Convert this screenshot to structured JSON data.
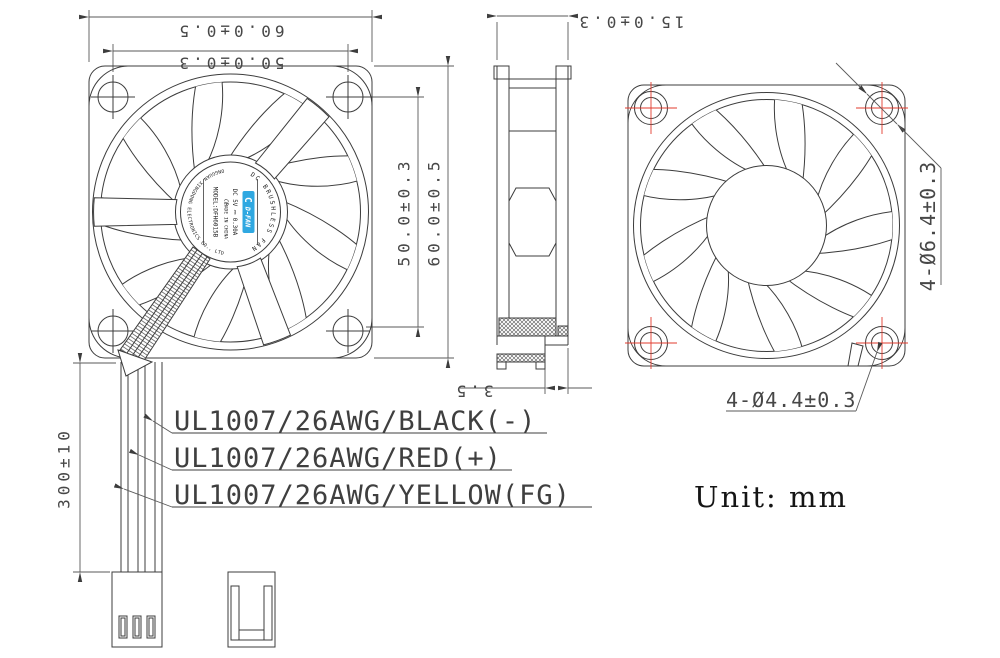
{
  "unit_note": "Unit: mm",
  "front_view": {
    "dim_top_outer": "60.0±0.5",
    "dim_top_inner": "50.0±0.3",
    "dim_right_inner": "50.0±0.3",
    "dim_right_outer": "60.0±0.5",
    "hub_label": {
      "arc_top": "DC BRUSHLESS FAN",
      "arc_bottom": "DONGGUAN XINGDONG ELECTRONICS CO., LTD.",
      "brand": "D-FAN",
      "brand_mark": "C",
      "model": "MODEL:DFH6015B",
      "rating": "DC 5V ⎓ 0.30A",
      "ce_mark": "CE",
      "origin": "MADE IN CHINA"
    }
  },
  "side_view": {
    "dim_thickness": "15.0±0.3",
    "dim_hub_step": "3.5"
  },
  "rear_view": {
    "callout_hole_outer": "4-Ø6.4±0.3",
    "callout_hole_inner": "4-Ø4.4±0.3"
  },
  "wiring": {
    "dim_lead_length": "300±10",
    "wire_labels": [
      "UL1007/26AWG/BLACK(-)",
      "UL1007/26AWG/RED(+)",
      "UL1007/26AWG/YELLOW(FG)"
    ]
  },
  "colors": {
    "line": "#3c3c3c",
    "dim_line": "#5a5a5a",
    "dim_text": "#474747",
    "center_mark_red": "#e23b2e",
    "logo_blue": "#2fa8e1"
  }
}
